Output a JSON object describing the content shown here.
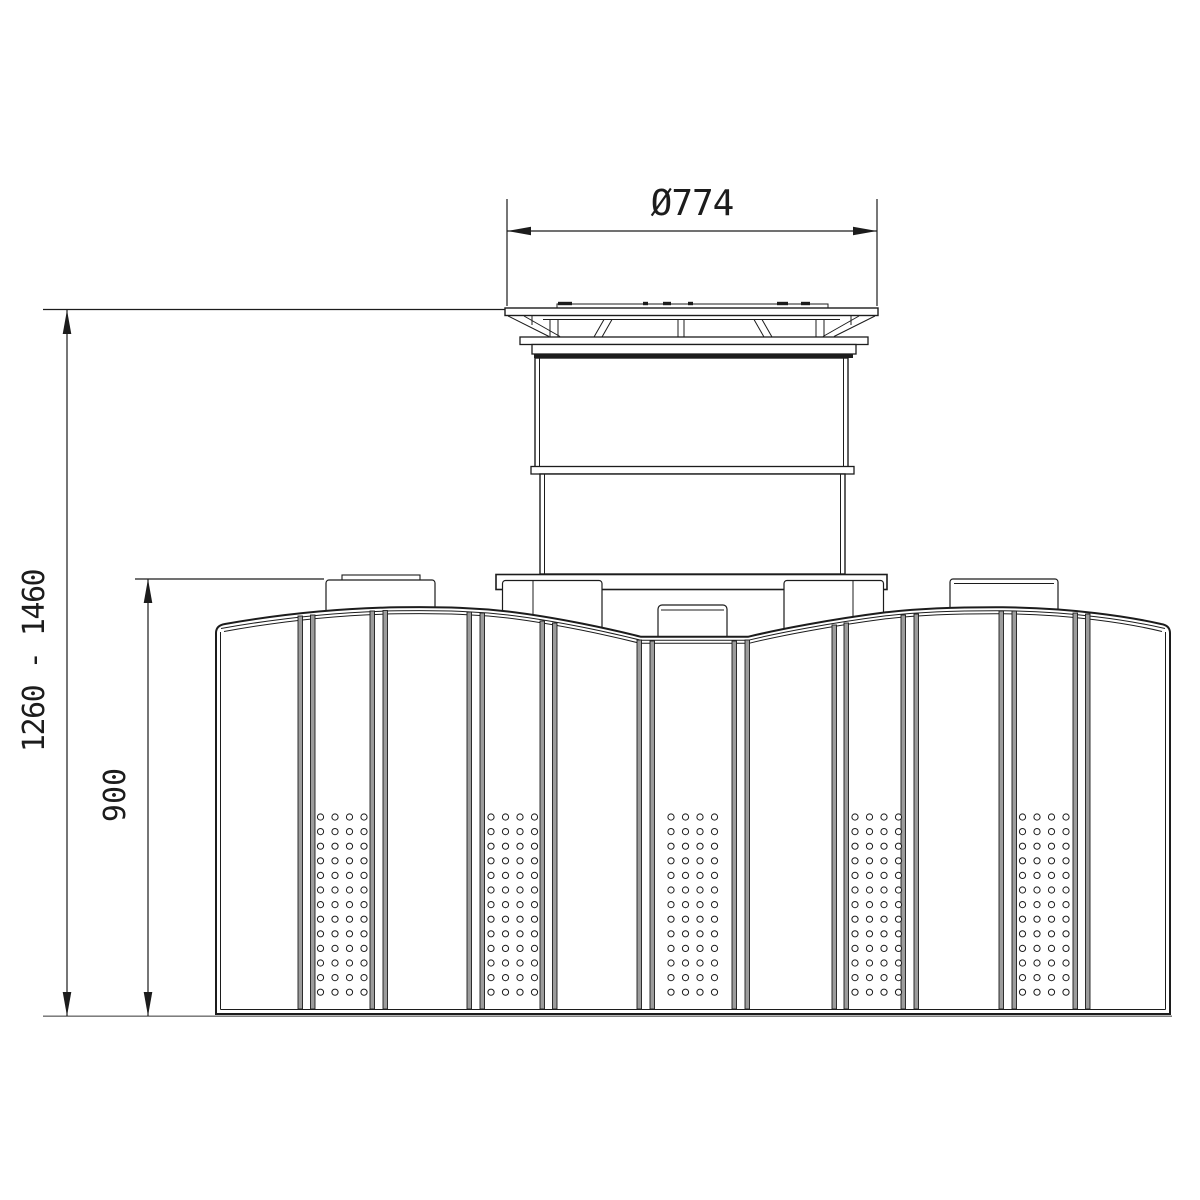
{
  "page": {
    "background": "#ffffff"
  },
  "drawing": {
    "type": "technical-front-view-flat-tank",
    "line_color": "#1c1c1c",
    "rib_fill": "#9c9c9c",
    "ground_color": "#6b6b6b",
    "labels": {
      "diameter": "Ø774",
      "overall_height_range": "1260 - 1460",
      "tank_height": "900"
    }
  }
}
